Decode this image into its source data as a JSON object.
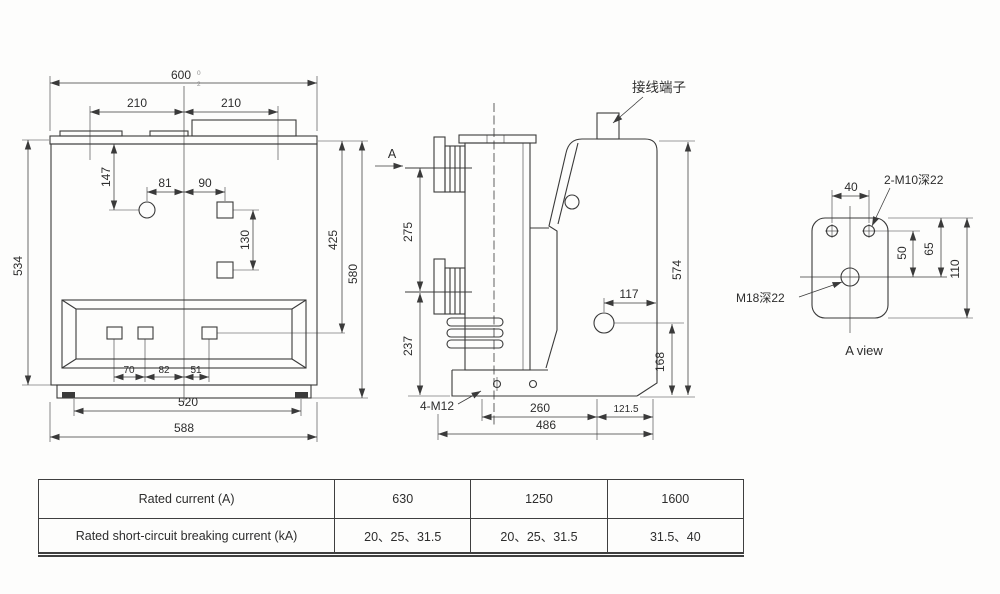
{
  "front_view": {
    "dims": {
      "width_overall": "600",
      "tol_upper": "0",
      "tol_lower": "2",
      "top_left": "210",
      "top_right": "210",
      "v147": "147",
      "h81": "81",
      "h90": "90",
      "v130": "130",
      "v425": "425",
      "v580": "580",
      "v534": "534",
      "b70": "70",
      "b82": "82",
      "b51": "51",
      "b520": "520",
      "b588": "588"
    }
  },
  "side_view": {
    "labels": {
      "terminal": "接线端子",
      "view_arrow": "A",
      "bolts": "4-M12"
    },
    "dims": {
      "v275": "275",
      "v237": "237",
      "v574": "574",
      "h117": "117",
      "v168": "168",
      "b260": "260",
      "b121_5": "121.5",
      "b486": "486"
    }
  },
  "a_view": {
    "labels": {
      "m10": "2-M10深22",
      "m18": "M18深22",
      "caption": "A view"
    },
    "dims": {
      "h40": "40",
      "v50": "50",
      "v65": "65",
      "v110": "110"
    }
  },
  "table": {
    "rows": [
      {
        "label": "Rated current (A)",
        "values": [
          "630",
          "1250",
          "1600"
        ]
      },
      {
        "label": "Rated short-circuit breaking current (kA)",
        "values": [
          "20、25、31.5",
          "20、25、31.5",
          "31.5、40"
        ]
      }
    ]
  }
}
